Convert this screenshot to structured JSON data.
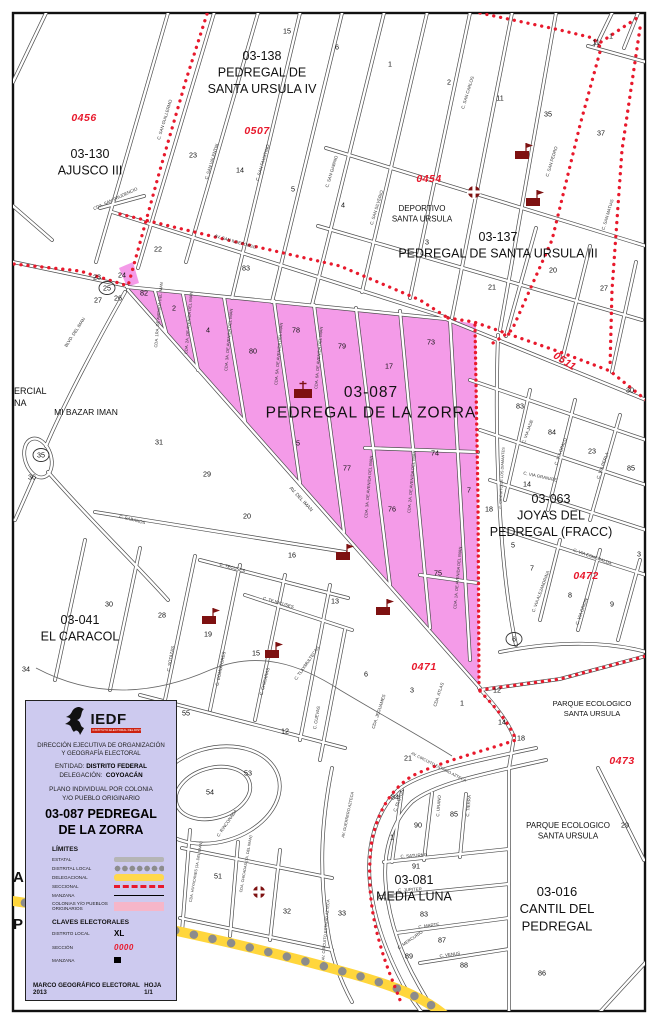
{
  "colors": {
    "seccional_red": "#E8192C",
    "colonia_pink": "#F49BE8",
    "legend_bg": "#CDCAEF",
    "delegacional_yellow": "#FFD63C",
    "distrital_gray": "#8C8C8C",
    "estatal_gray": "#B5B5B5",
    "colonias_swatch_pink": "#F6B6C9",
    "icon_maroon": "#7E1111"
  },
  "legend": {
    "logo_text": "IEDF",
    "logo_tagline": "INSTITUTO ELECTORAL DEL DISTRITO FEDERAL",
    "org_line1": "DIRECCIÓN EJECUTIVA DE ORGANIZACIÓN",
    "org_line2": "Y GEOGRAFÍA ELECTORAL",
    "entidad_label": "ENTIDAD:",
    "entidad_value": "DISTRITO FEDERAL",
    "delegacion_label": "DELEGACIÓN:",
    "delegacion_value": "COYOACÁN",
    "plano_line1": "PLANO INDIVIDUAL POR COLONIA",
    "plano_line2": "Y/O PUEBLO ORIGINARIO",
    "colonia_line1": "03-087  PEDREGAL",
    "colonia_line2": "DE LA ZORRA",
    "limites_title": "LÍMITES",
    "limites": [
      {
        "label": "ESTATAL"
      },
      {
        "label": "DISTRITAL LOCAL"
      },
      {
        "label": "DELEGACIONAL"
      },
      {
        "label": "SECCIONAL"
      },
      {
        "label": "MANZANA"
      },
      {
        "label": "COLONIAS Y/O PUEBLOS ORIGINARIOS"
      }
    ],
    "claves_title": "CLAVES ELECTORALES",
    "claves": [
      {
        "label": "DISTRITO LOCAL",
        "value": "XL"
      },
      {
        "label": "SECCIÓN",
        "value": "0000"
      },
      {
        "label": "MANZANA",
        "value": "00"
      }
    ],
    "footer_left": "MARCO GEOGRÁFICO ELECTORAL  2013",
    "footer_right": "HOJA 1/1"
  },
  "map": {
    "neighborhoods": [
      {
        "lines": [
          "03-138",
          "PEDREGAL DE",
          "SANTA URSULA IV"
        ],
        "x": 262,
        "y": 60,
        "size": 12.5
      },
      {
        "lines": [
          "03-130",
          "AJUSCO III"
        ],
        "x": 90,
        "y": 158,
        "size": 12.5
      },
      {
        "lines": [
          "03-137",
          "PEDREGAL DE SANTA URSULA III"
        ],
        "x": 498,
        "y": 241,
        "size": 12.5
      },
      {
        "lines": [
          "DEPORTIVO",
          "SANTA URSULA"
        ],
        "x": 422,
        "y": 211,
        "size": 8
      },
      {
        "lines": [
          "03-087",
          "PEDREGAL DE LA ZORRA"
        ],
        "x": 371,
        "y": 397,
        "size": 15.5,
        "ls": 1
      },
      {
        "lines": [
          "03-063",
          "JOYAS DEL",
          "PEDREGAL (FRACC)"
        ],
        "x": 551,
        "y": 503,
        "size": 12.5
      },
      {
        "lines": [
          "03-041",
          "EL CARACOL"
        ],
        "x": 80,
        "y": 624,
        "size": 12.5
      },
      {
        "lines": [
          "MI BAZAR IMAN"
        ],
        "x": 86,
        "y": 415,
        "size": 8.5
      },
      {
        "lines": [
          "PARQUE ECOLOGICO",
          "SANTA URSULA"
        ],
        "x": 592,
        "y": 706,
        "size": 7.5
      },
      {
        "lines": [
          "PARQUE ECOLOGICO",
          "SANTA URSULA"
        ],
        "x": 568,
        "y": 828,
        "size": 8
      },
      {
        "lines": [
          "03-081",
          "MEDIA LUNA"
        ],
        "x": 414,
        "y": 884,
        "size": 12.5
      },
      {
        "lines": [
          "03-016",
          "CANTIL DEL",
          "PEDREGAL"
        ],
        "x": 557,
        "y": 896,
        "size": 13
      }
    ],
    "sections": [
      {
        "code": "0456",
        "x": 84,
        "y": 118
      },
      {
        "code": "0507",
        "x": 257,
        "y": 131
      },
      {
        "code": "0454",
        "x": 429,
        "y": 179
      },
      {
        "code": "0511",
        "x": 563,
        "y": 361,
        "rot": 33
      },
      {
        "code": "0472",
        "x": 586,
        "y": 576
      },
      {
        "code": "0471",
        "x": 424,
        "y": 667
      },
      {
        "code": "0473",
        "x": 622,
        "y": 761
      }
    ],
    "blocks": {
      "format": [
        "n",
        "x",
        "y",
        "circled"
      ],
      "items": [
        [
          "15",
          287,
          31
        ],
        [
          "6",
          337,
          47
        ],
        [
          "1",
          390,
          64
        ],
        [
          "2",
          449,
          82
        ],
        [
          "11",
          500,
          98
        ],
        [
          "35",
          548,
          114
        ],
        [
          "37",
          601,
          133
        ],
        [
          "11",
          596,
          42
        ],
        [
          "1",
          611,
          36
        ],
        [
          "23",
          193,
          155
        ],
        [
          "14",
          240,
          170
        ],
        [
          "5",
          293,
          189
        ],
        [
          "22",
          158,
          249
        ],
        [
          "4",
          343,
          205
        ],
        [
          "3",
          427,
          242
        ],
        [
          "83",
          246,
          268
        ],
        [
          "20",
          553,
          270
        ],
        [
          "21",
          492,
          287
        ],
        [
          "27",
          604,
          288
        ],
        [
          "30",
          630,
          390
        ],
        [
          "23",
          97,
          277
        ],
        [
          "24",
          122,
          275
        ],
        [
          "25",
          107,
          288,
          true
        ],
        [
          "27",
          98,
          300
        ],
        [
          "26",
          118,
          298
        ],
        [
          "82",
          144,
          293
        ],
        [
          "2",
          174,
          308
        ],
        [
          "4",
          208,
          330
        ],
        [
          "80",
          253,
          351
        ],
        [
          "78",
          296,
          330
        ],
        [
          "79",
          342,
          346
        ],
        [
          "73",
          431,
          342
        ],
        [
          "17",
          389,
          366
        ],
        [
          "35",
          41,
          455,
          true
        ],
        [
          "36",
          32,
          477
        ],
        [
          "31",
          159,
          442
        ],
        [
          "29",
          207,
          474
        ],
        [
          "5",
          298,
          443
        ],
        [
          "83",
          520,
          406
        ],
        [
          "84",
          552,
          432
        ],
        [
          "23",
          592,
          451
        ],
        [
          "85",
          631,
          468
        ],
        [
          "14",
          527,
          484
        ],
        [
          "18",
          489,
          509
        ],
        [
          "77",
          347,
          468
        ],
        [
          "74",
          435,
          453
        ],
        [
          "7",
          469,
          490
        ],
        [
          "76",
          392,
          509
        ],
        [
          "75",
          438,
          573
        ],
        [
          "13",
          335,
          601
        ],
        [
          "6",
          366,
          674
        ],
        [
          "3",
          412,
          690
        ],
        [
          "1",
          462,
          703
        ],
        [
          "12",
          497,
          690
        ],
        [
          "5",
          513,
          545
        ],
        [
          "7",
          532,
          568
        ],
        [
          "3",
          639,
          554
        ],
        [
          "8",
          570,
          595
        ],
        [
          "9",
          612,
          604
        ],
        [
          "6",
          514,
          639,
          true
        ],
        [
          "14",
          502,
          722
        ],
        [
          "18",
          521,
          738
        ],
        [
          "21",
          408,
          758
        ],
        [
          "20",
          247,
          516
        ],
        [
          "16",
          292,
          555
        ],
        [
          "30",
          109,
          604
        ],
        [
          "28",
          162,
          615
        ],
        [
          "19",
          208,
          634
        ],
        [
          "15",
          256,
          653
        ],
        [
          "34",
          26,
          669
        ],
        [
          "55",
          186,
          713
        ],
        [
          "12",
          285,
          731
        ],
        [
          "53",
          248,
          773
        ],
        [
          "54",
          210,
          792
        ],
        [
          "51",
          218,
          876
        ],
        [
          "32",
          287,
          911
        ],
        [
          "84",
          395,
          797
        ],
        [
          "90",
          418,
          825
        ],
        [
          "85",
          454,
          814
        ],
        [
          "1",
          392,
          837
        ],
        [
          "91",
          416,
          866
        ],
        [
          "83",
          424,
          914
        ],
        [
          "87",
          442,
          940
        ],
        [
          "89",
          409,
          956
        ],
        [
          "88",
          464,
          965
        ],
        [
          "33",
          342,
          913
        ],
        [
          "29",
          625,
          825
        ],
        [
          "86",
          542,
          973
        ]
      ]
    },
    "streets": {
      "format": [
        "name",
        "x",
        "y",
        "rot",
        "size"
      ],
      "items": [
        [
          "C. SAN GUILLERMO",
          166,
          120,
          -73
        ],
        [
          "CDA. SAN PRUDENCIO",
          116,
          200,
          -25
        ],
        [
          "AV. SAN ILDEFONSO",
          235,
          243,
          16
        ],
        [
          "C. SAN VALENTIN",
          213,
          162,
          -73
        ],
        [
          "C. SAN FAUSTINO",
          264,
          163,
          -73
        ],
        [
          "C. SAN GABINO",
          333,
          172,
          -73
        ],
        [
          "C. SAN SILVERIO",
          378,
          208,
          -73
        ],
        [
          "C. SAN CARLOS",
          469,
          93,
          -73
        ],
        [
          "C. SAN PEDRO",
          553,
          162,
          -73
        ],
        [
          "C. SAN MATIAS",
          609,
          215,
          -73
        ],
        [
          "BLVD. DEL IMAN",
          76,
          333,
          -57
        ],
        [
          "CDA. 1RA. DE AVENIDA DEL IMAN",
          160,
          315,
          -85,
          4.1
        ],
        [
          "CDA. 2A. DE AVENIDA DEL IMAN",
          190,
          323,
          -85,
          4.1
        ],
        [
          "CDA. 3A. DE AVENIDA DEL IMAN",
          230,
          340,
          -85,
          4.1
        ],
        [
          "CDA. 5A. DE AVENIDA DEL IMAN",
          280,
          354,
          -85,
          4.1
        ],
        [
          "CDA. 6A. DE AVENIDA DEL IMAN",
          320,
          358,
          -85,
          4.1
        ],
        [
          "CDA. 3A. DE AVENIDA DEL IMAN",
          370,
          487,
          -85,
          4.1
        ],
        [
          "CDA. 2A. DE AVENIDA DEL IMAN",
          413,
          482,
          -85,
          4.1
        ],
        [
          "CDA. 1A. DE AVENIDA DEL IMAN",
          459,
          578,
          -85,
          4.1
        ],
        [
          "AV. DEL IMAN",
          300,
          500,
          47,
          5
        ],
        [
          "C. SABANOS",
          132,
          521,
          14
        ],
        [
          "C. TECUSES",
          232,
          569,
          15
        ],
        [
          "C. TEJOCUSES",
          278,
          604,
          16
        ],
        [
          "C. SOTAZAS",
          172,
          659,
          -80
        ],
        [
          "C. COMOPORES",
          222,
          669,
          -78
        ],
        [
          "C. CHICARAS",
          266,
          682,
          -75
        ],
        [
          "C. TLAXMULTECAS",
          308,
          664,
          -55
        ],
        [
          "C. CUEVAS",
          318,
          718,
          -80
        ],
        [
          "CDA. JEGUAMES",
          380,
          712,
          -72
        ],
        [
          "CDA. ATLAS",
          440,
          695,
          -72
        ],
        [
          "AV. CIRCUITO ESTADIO AZTECA",
          438,
          768,
          27,
          4
        ],
        [
          "AV. CIRCUITO ESTADIO AZTECA",
          327,
          930,
          -85,
          4
        ],
        [
          "C. PLUTON",
          400,
          801,
          -70
        ],
        [
          "C. URANO",
          440,
          806,
          -85
        ],
        [
          "C. TIERRA",
          470,
          806,
          -85
        ],
        [
          "C. SATURNO",
          414,
          857,
          -4
        ],
        [
          "C. JUPITER",
          410,
          891,
          -3
        ],
        [
          "C. MARTE",
          429,
          927,
          -8
        ],
        [
          "C. MERCURIO",
          411,
          941,
          -35
        ],
        [
          "C. VENUS",
          450,
          956,
          -8
        ],
        [
          "C. RINCONADA",
          228,
          824,
          -55
        ],
        [
          "CDA. HUYACANES (1A. DEL IMAN)",
          197,
          872,
          -80,
          3.8
        ],
        [
          "CDA. CHICADAS (7A. DEL IMAN)",
          247,
          864,
          -80,
          3.8
        ],
        [
          "AV. GUERRERO AZTECA",
          349,
          815,
          -78,
          4
        ],
        [
          "C. VIA JADE",
          529,
          432,
          -70
        ],
        [
          "C. VIA OPALO",
          562,
          452,
          -70
        ],
        [
          "C. VIA PERLA",
          604,
          466,
          -70
        ],
        [
          "C. CIRCUITO DE LOS DIAMANTES",
          503,
          478,
          -87,
          3.8
        ],
        [
          "C. VIA GRANATE",
          540,
          478,
          12
        ],
        [
          "C. VIA ESMERALDA",
          592,
          558,
          20
        ],
        [
          "C. VIA ALEJANDRINA",
          542,
          592,
          -70
        ],
        [
          "C. VIA ORION",
          583,
          612,
          -70
        ]
      ]
    },
    "fragments": [
      {
        "text": "ERCIAL",
        "x": 14,
        "y": 394,
        "size": 9
      },
      {
        "text": "NA",
        "x": 14,
        "y": 406,
        "size": 9
      },
      {
        "text": "A",
        "x": 13,
        "y": 882,
        "size": 15
      },
      {
        "text": "P",
        "x": 13,
        "y": 929,
        "size": 15
      }
    ],
    "icons": [
      {
        "type": "flag",
        "x": 522,
        "y": 155
      },
      {
        "type": "flag",
        "x": 533,
        "y": 202
      },
      {
        "type": "flag",
        "x": 209,
        "y": 620
      },
      {
        "type": "flag",
        "x": 272,
        "y": 654
      },
      {
        "type": "flag",
        "x": 343,
        "y": 556
      },
      {
        "type": "flag",
        "x": 383,
        "y": 611
      },
      {
        "type": "church",
        "x": 303,
        "y": 392
      },
      {
        "type": "roundcross",
        "x": 474,
        "y": 192
      },
      {
        "type": "roundcross",
        "x": 259,
        "y": 892
      }
    ]
  }
}
